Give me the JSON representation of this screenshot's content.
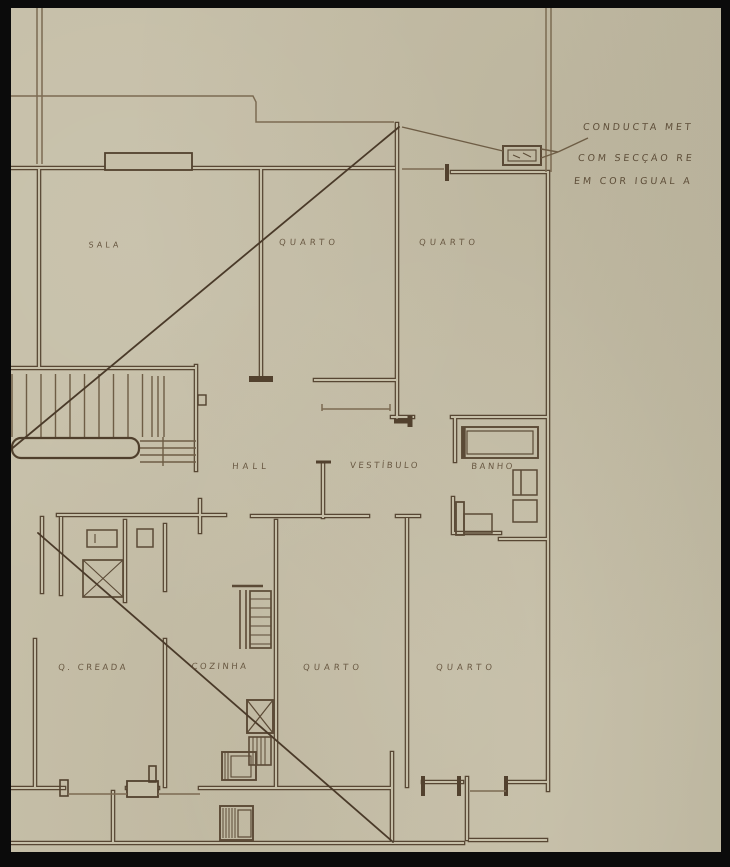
{
  "drawing": {
    "kind": "architectural floor plan, hand-drawn sepia ink on aged paper",
    "colors": {
      "paper": "#c6bfa8",
      "ink": "#574633",
      "ink_thin": "#7c6b52",
      "ink_dark": "#4a3a29",
      "label": "#5d4b35",
      "frame": "#0b0b0b"
    }
  },
  "rooms": [
    {
      "label": "SALA"
    },
    {
      "label": "QUARTO"
    },
    {
      "label": "QUARTO"
    },
    {
      "label": "HALL"
    },
    {
      "label": "VESTÍBULO"
    },
    {
      "label": "BANHO"
    },
    {
      "label": "Q. CREADA"
    },
    {
      "label": "COZINHA"
    },
    {
      "label": "QUARTO"
    },
    {
      "label": "QUARTO"
    }
  ],
  "edge_fragment": "A",
  "annotation": {
    "line1": "CONDUCTA MET",
    "line2": "COM SECÇÃO RE",
    "line3": "EM COR IGUAL A"
  }
}
